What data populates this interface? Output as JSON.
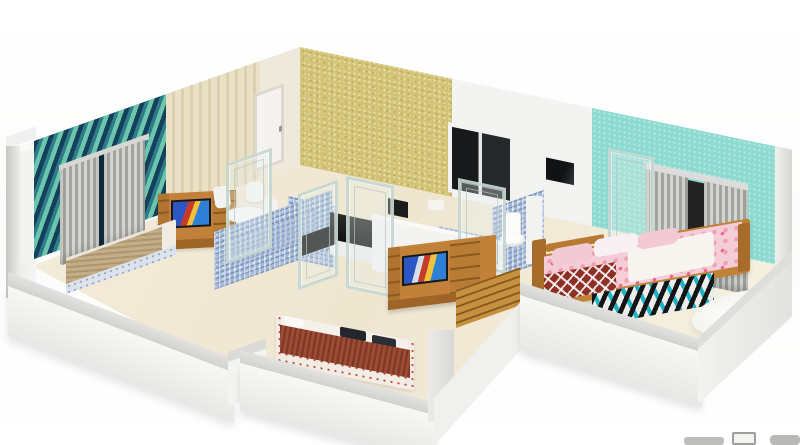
{
  "scene": {
    "title": "3D isometric cutaway floor plan render of an apartment",
    "view": "isometric cutaway, viewed from front",
    "background": "#ffffff",
    "text_visible": "none"
  },
  "colors": {
    "wall-white": "#f3f3f1",
    "floor-cream": "#f4eedd",
    "teal-dark": "#14405c",
    "teal-mid": "#2e7c88",
    "teal-light": "#6cc6ad",
    "cream-base": "#eae0c6",
    "cream-stripe": "#dbd0b0",
    "door-white": "#f5f3ef",
    "yellow-base": "#d2c377",
    "yellow-dot-dark": "#bfae58",
    "yellow-dot-light": "#e8dfae",
    "window-dark": "#17191a",
    "cyan-base": "#8edad0",
    "cyan-dot": "#b4eae2",
    "wood": "#c28138",
    "wood-dark": "#9e6526",
    "tile-base": "#a3b8d6",
    "counter-black": "#131313",
    "bed-tan": "#c4ae88",
    "bed-maroon": "#9d4b34",
    "pink-bedding": "#f5cdd9",
    "blanket-red": "#8e3026",
    "rug-teal": "#1cb3c6",
    "rug-black": "#151515",
    "step-wood": "#c4913f",
    "yellow-accent": "#f4cf3d",
    "glass-fill": "rgba(231,243,240,0.3)"
  },
  "rooms": [
    {
      "name": "left-bedroom",
      "accent_wall": "teal 3D geometric wallpaper",
      "items": [
        "gray window curtains",
        "double bed with tan blanket",
        "wooden tv unit with tv"
      ]
    },
    {
      "name": "dining-area",
      "items": [
        "white round table",
        "white chairs",
        "glass partition doors"
      ]
    },
    {
      "name": "kitchen",
      "accent_wall": "yellow textured wallpaper",
      "items": [
        "black l-shaped countertop",
        "dark windows"
      ]
    },
    {
      "name": "bathrooms",
      "items": [
        "blue mosaic tiled walls",
        "white toilet"
      ]
    },
    {
      "name": "hall",
      "items": [
        "wooden tv unit with tv",
        "wooden slat walkway",
        "glass partitions"
      ]
    },
    {
      "name": "middle-bedroom",
      "items": [
        "double bed with maroon knit blanket and printed sheet",
        "dark pillows"
      ]
    },
    {
      "name": "master-bedroom",
      "accent_wall": "cyan textured wallpaper",
      "items": [
        "wooden double bed with pink floral bedding",
        "red diamond-pattern throw",
        "geometric black-teal rug",
        "white fur rug",
        "gray window curtains"
      ]
    }
  ],
  "watermark": {
    "note": "unreadable gray logo fragment cropped at bottom-right edge"
  }
}
